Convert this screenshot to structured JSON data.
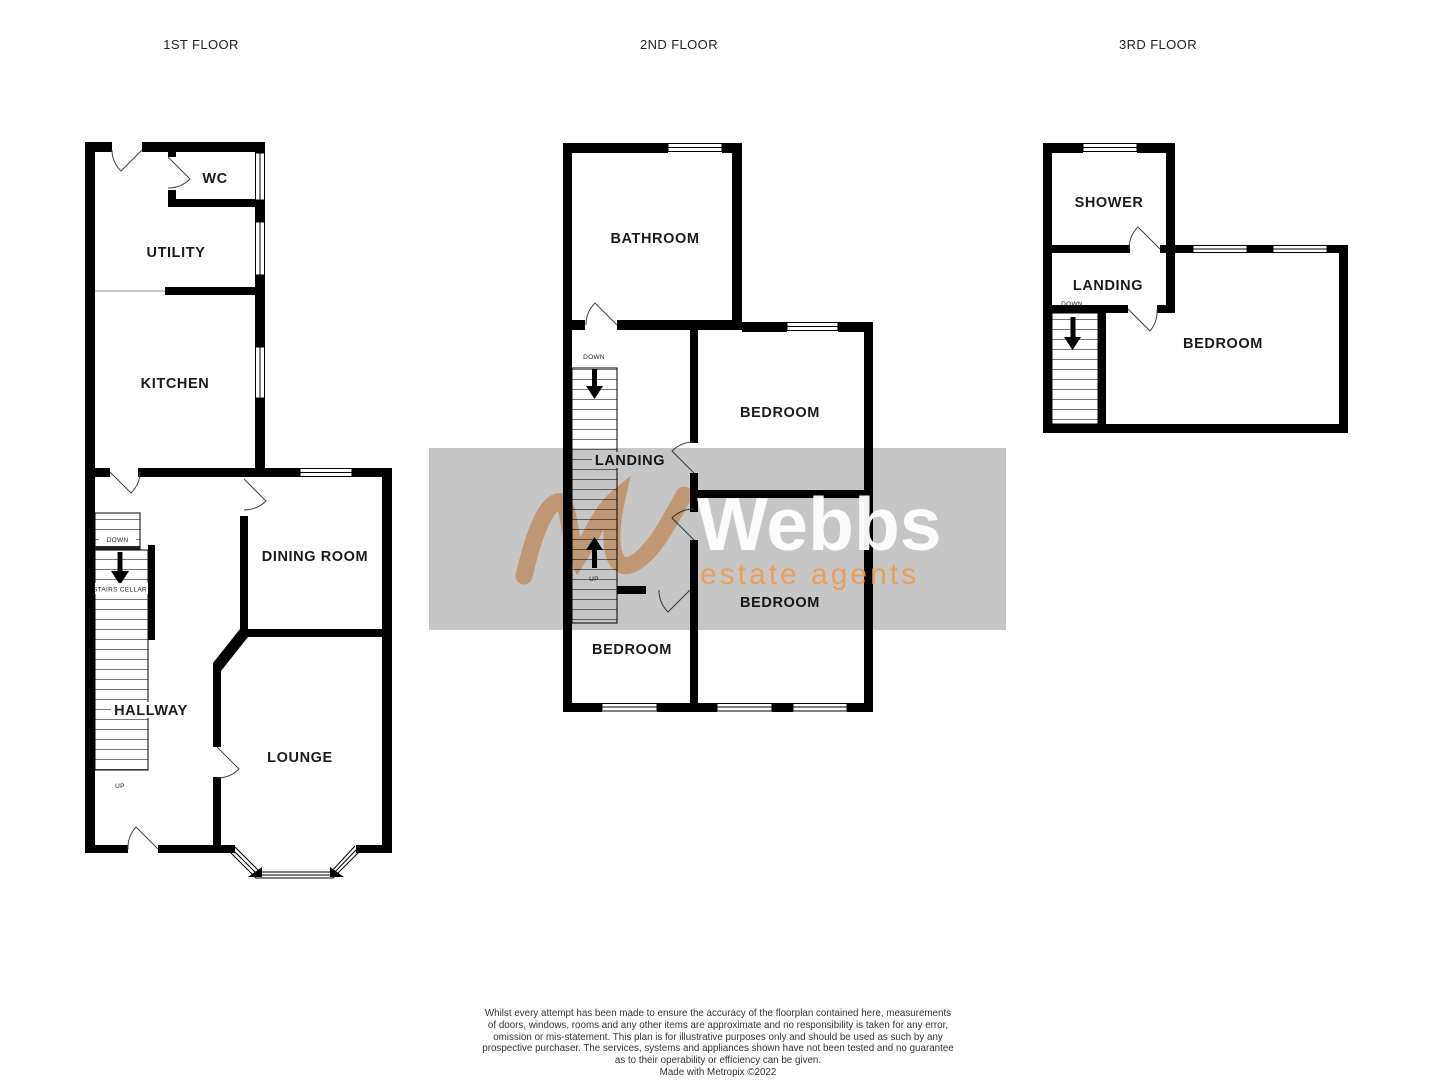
{
  "floors": {
    "f1": {
      "title": "1ST FLOOR",
      "wc": "WC",
      "utility": "UTILITY",
      "kitchen": "KITCHEN",
      "dining": "DINING ROOM",
      "hallway": "HALLWAY",
      "lounge": "LOUNGE",
      "cellar_down": "DOWN",
      "stairs_cellar": "STAIRS CELLAR",
      "up": "UP"
    },
    "f2": {
      "title": "2ND FLOOR",
      "bathroom": "BATHROOM",
      "bedroom_top": "BEDROOM",
      "bedroom_right": "BEDROOM",
      "bedroom_left": "BEDROOM",
      "landing": "LANDING",
      "down": "DOWN",
      "up": "UP"
    },
    "f3": {
      "title": "3RD FLOOR",
      "shower": "SHOWER",
      "landing": "LANDING",
      "bedroom": "BEDROOM",
      "down": "DOWN"
    }
  },
  "watermark": {
    "brand": "Webbs",
    "tagline": "estate agents",
    "band_color": "#c6c6c6",
    "orange": "#f09a4f",
    "white": "#ffffff"
  },
  "disclaimer": {
    "line1": "Whilst every attempt has been made to ensure the accuracy of the floorplan contained here, measurements",
    "line2": "of doors, windows, rooms and any other items are approximate and no responsibility is taken for any error,",
    "line3": "omission or mis-statement. This plan is for illustrative purposes only and should be used as such by any",
    "line4": "prospective purchaser. The services, systems and appliances shown have not been tested and no guarantee",
    "line5": "as to their operability or efficiency can be given.",
    "credit": "Made with Metropix ©2022"
  }
}
